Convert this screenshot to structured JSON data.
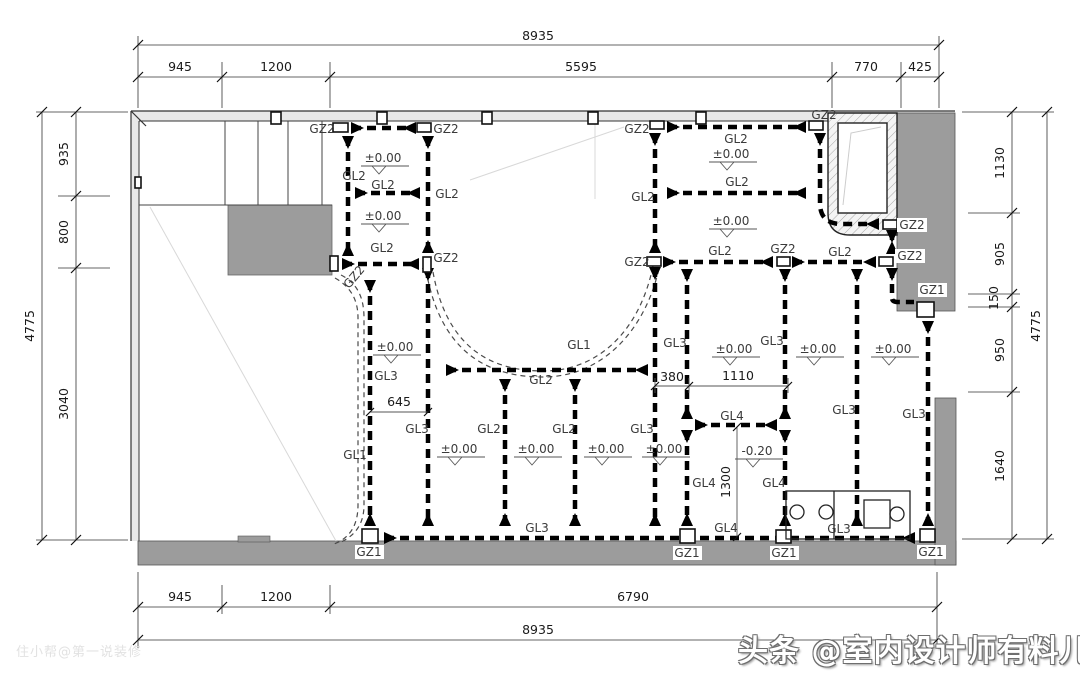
{
  "labels": {
    "gz1": "GZ1",
    "gz2": "GZ2",
    "gl1": "GL1",
    "gl2": "GL2",
    "gl3": "GL3",
    "gl4": "GL4",
    "level_zero": "±0.00",
    "level_minus": "-0.20"
  },
  "dimensions": {
    "top": {
      "total": "8935",
      "segments": [
        "945",
        "1200",
        "5595",
        "770",
        "425"
      ]
    },
    "bottom": {
      "total": "8935",
      "segments": [
        "945",
        "1200",
        "6790"
      ]
    },
    "left": {
      "total": "4775",
      "segments": [
        "935",
        "800",
        "3040"
      ]
    },
    "right": {
      "total": "4775",
      "segments": [
        "1130",
        "905",
        "150",
        "950",
        "1640"
      ]
    },
    "inner": {
      "w645": "645",
      "w380": "380",
      "w1110": "1110",
      "h1300": "1300"
    }
  },
  "watermarks": {
    "bottom_right": "头条 @室内设计师有料儿",
    "bottom_left": "住小帮@第一说装修"
  },
  "colors": {
    "wall_gray": "#9c9c9c",
    "wall_light": "#e8e8e8",
    "beam_black": "#000000",
    "faint_line": "#d8d8d8"
  }
}
